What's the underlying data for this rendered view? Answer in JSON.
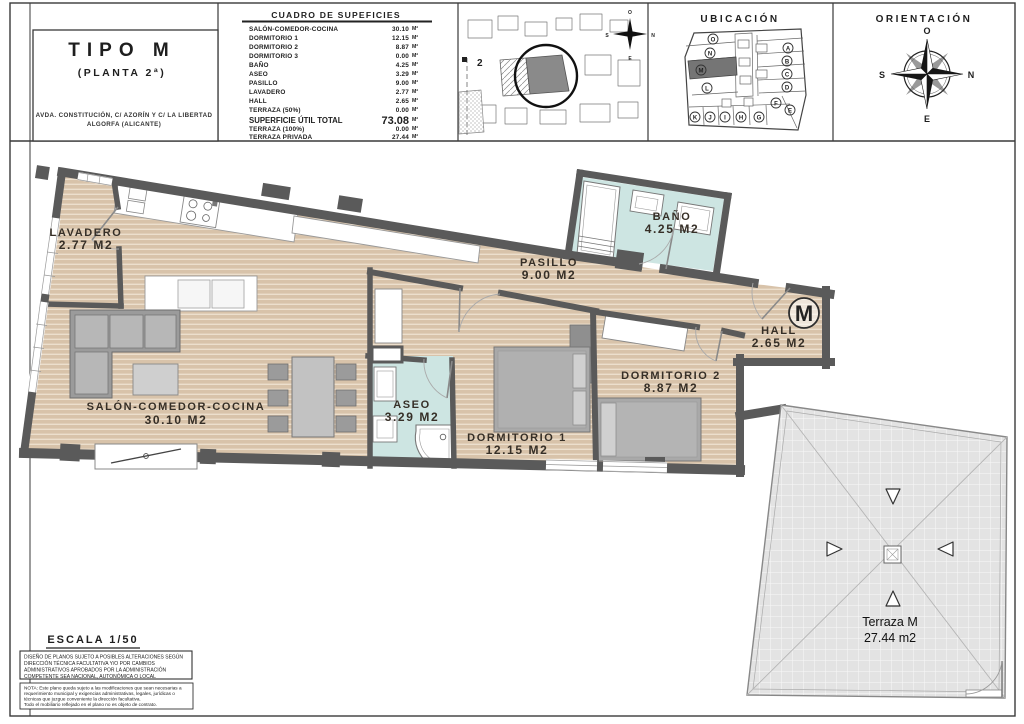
{
  "header": {
    "title_block": {
      "type_label": "TIPO M",
      "floor_label": "(PLANTA 2ª)",
      "address_line1": "AVDA. CONSTITUCIÓN, C/ AZORÍN Y C/ LA LIBERTAD",
      "address_line2": "ALGORFA (ALICANTE)"
    },
    "surface_table": {
      "title": "CUADRO DE SUPEFICIES",
      "rows": [
        {
          "label": "SALÓN-COMEDOR-COCINA",
          "value": "30.10",
          "unit": "M²"
        },
        {
          "label": "DORMITORIO 1",
          "value": "12.15",
          "unit": "M²"
        },
        {
          "label": "DORMITORIO 2",
          "value": "8.87",
          "unit": "M²"
        },
        {
          "label": "DORMITORIO 3",
          "value": "0.00",
          "unit": "M²"
        },
        {
          "label": "BAÑO",
          "value": "4.25",
          "unit": "M²"
        },
        {
          "label": "ASEO",
          "value": "3.29",
          "unit": "M²"
        },
        {
          "label": "PASILLO",
          "value": "9.00",
          "unit": "M²"
        },
        {
          "label": "LAVADERO",
          "value": "2.77",
          "unit": "M²"
        },
        {
          "label": "HALL",
          "value": "2.65",
          "unit": "M²"
        },
        {
          "label": "TERRAZA (50%)",
          "value": "0.00",
          "unit": "M²"
        }
      ],
      "total_row": {
        "label": "SUPERFICIE ÚTIL TOTAL",
        "value": "73.08",
        "unit": "M²"
      },
      "terraza_100": {
        "label": "TERRAZA (100%)",
        "value": "0.00",
        "unit": "M²"
      },
      "terraza_privada": {
        "label": "TERRAZA PRIVADA",
        "value": "27.44",
        "unit": "M²"
      }
    },
    "site_plan": {
      "block_label": "2",
      "compass": {
        "top": "O",
        "left": "S",
        "right": "N",
        "bottom": "E"
      }
    },
    "ubicacion": {
      "title": "UBICACIÓN",
      "highlighted_unit": "M",
      "units": [
        "O",
        "N",
        "M",
        "L",
        "A",
        "B",
        "C",
        "D",
        "E",
        "F",
        "G",
        "H",
        "I",
        "J",
        "K"
      ]
    },
    "orientacion": {
      "title": "ORIENTACIÓN",
      "compass": {
        "top": "O",
        "left": "S",
        "right": "N",
        "bottom": "E"
      }
    }
  },
  "plan": {
    "rooms": [
      {
        "name": "LAVADERO",
        "area": "2.77 M2"
      },
      {
        "name": "SALÓN-COMEDOR-COCINA",
        "area": "30.10 M2"
      },
      {
        "name": "PASILLO",
        "area": "9.00 M2"
      },
      {
        "name": "BAÑO",
        "area": "4.25 M2"
      },
      {
        "name": "ASEO",
        "area": "3.29 M2"
      },
      {
        "name": "DORMITORIO 1",
        "area": "12.15 M2"
      },
      {
        "name": "DORMITORIO 2",
        "area": "8.87 M2"
      },
      {
        "name": "HALL",
        "area": "2.65 M2"
      }
    ],
    "unit_marker": "M",
    "terrace": {
      "name": "Terraza M",
      "area": "27.44 m2"
    },
    "colors": {
      "floor": "#d8c3aa",
      "floor_stripe": "#ecdfcd",
      "wet_floor": "#cde5e2",
      "wall": "#5a5a5a",
      "terrace": "#e3e3e3"
    }
  },
  "footer": {
    "scale_label": "ESCALA 1/50",
    "disclaimer_lines": [
      "DISEÑO DE PLANOS SUJETO A POSIBLES ALTERACIONES SEGÚN",
      "DIRECCIÓN TÉCNICA FACULTATIVA Y/O POR CAMBIOS",
      "ADMINISTRATIVOS APROBADOS POR LA ADMINISTRACIÓN",
      "COMPETENTE SEA NACIONAL, AUTONÓMICA O LOCAL"
    ],
    "note_lines": [
      "NOTA: Este plano queda sujeto a las modificaciones que sean necesarias a",
      "requerimiento municipal y exigencias administrativas, legales, jurídicas o",
      "técnicas que juzgue conveniente la dirección facultativa.",
      "Todo el mobiliario reflejado en el plano no es objeto de contrato."
    ]
  }
}
